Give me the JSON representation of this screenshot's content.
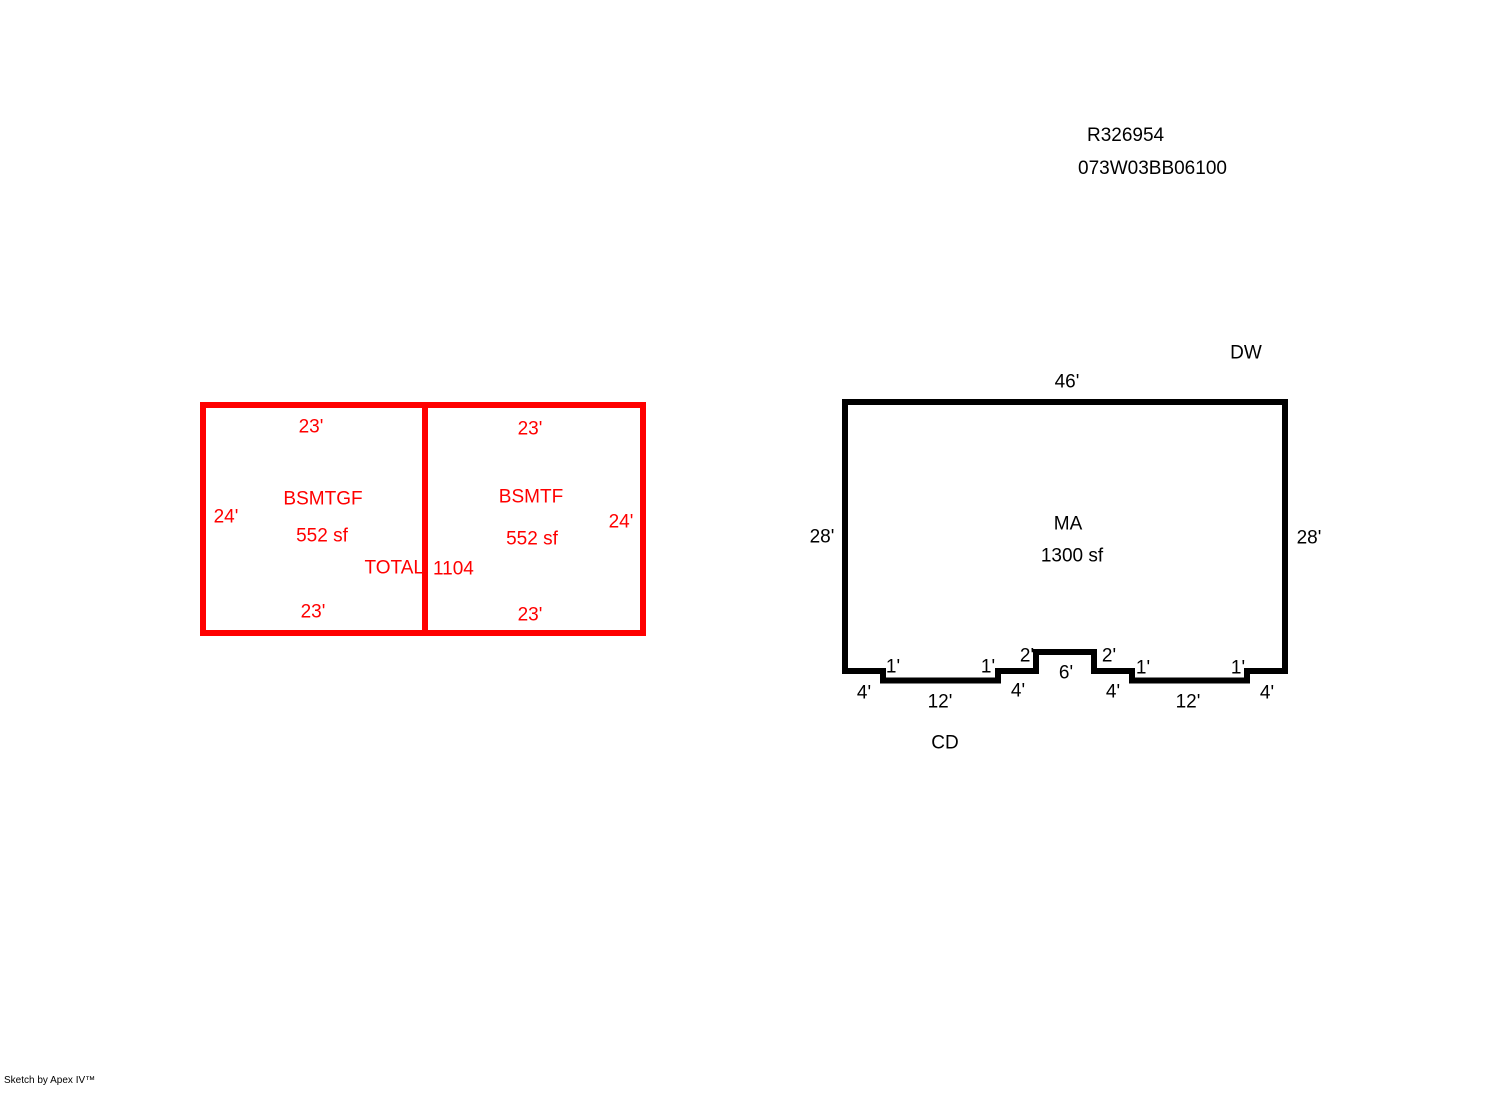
{
  "colors": {
    "basement_red": "#ff0000",
    "main_black": "#000000"
  },
  "header": {
    "record_number": "R326954",
    "parcel_id": "073W03BB06100"
  },
  "basement_sketch": {
    "left_room": {
      "name": "BSMTGF",
      "area": "552 sf",
      "dim_top": "23'",
      "dim_bottom": "23'",
      "dim_left": "24'"
    },
    "right_room": {
      "name": "BSMTF",
      "area": "552 sf",
      "dim_top": "23'",
      "dim_bottom": "23'",
      "dim_right": "24'"
    },
    "total_label": "TOTAL",
    "total_value": "1104"
  },
  "main_sketch": {
    "room": {
      "name": "MA",
      "area": "1300 sf"
    },
    "label_dw": "DW",
    "label_cd": "CD",
    "dim_top": "46'",
    "dim_left": "28'",
    "dim_right": "28'",
    "bottom_dims": {
      "d1": "4'",
      "d2": "1'",
      "d3": "12'",
      "d4": "1'",
      "d5": "4'",
      "d6": "2'",
      "d7": "6'",
      "d8": "2'",
      "d9": "4'",
      "d10": "1'",
      "d11": "12'",
      "d12": "1'",
      "d13": "4'"
    }
  },
  "footer": {
    "credit": "Sketch by Apex IV™"
  }
}
